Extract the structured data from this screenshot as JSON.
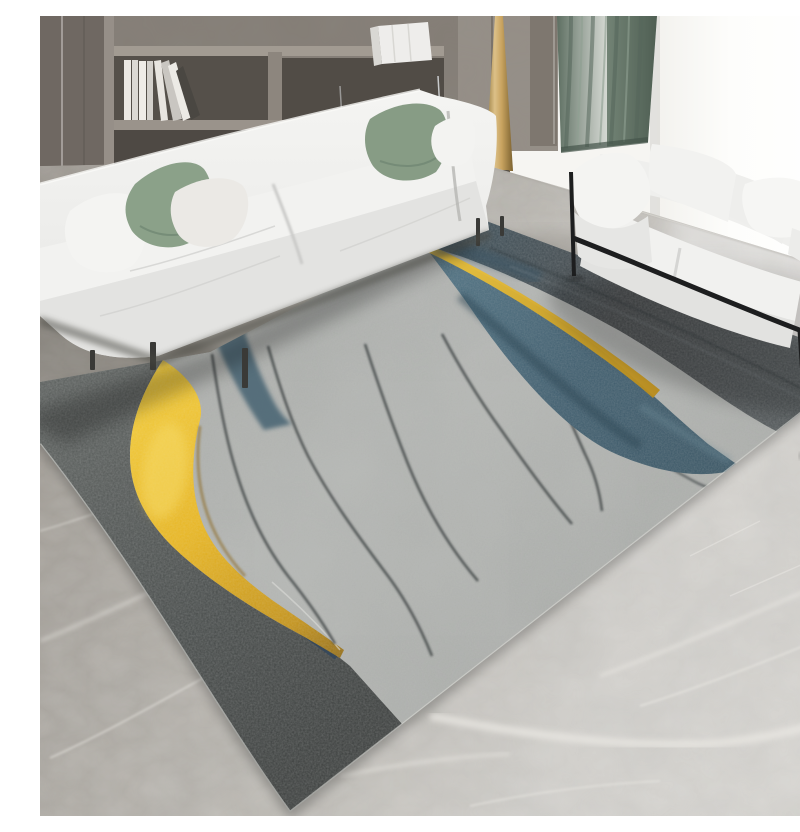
{
  "scene": {
    "description": "Photograph of a modern living room: white fabric sofa with sage-green and white pillows in front of a grey wood bookshelf, a white loveseat on a black metal frame by a bright window with a sage curtain and tall gold cone decor, all on grey marble tile flooring. A large abstract area rug lies in the centre with a mottled concrete-grey field, a dark charcoal wedge, a sweeping gold-foil crescent ribbon, steel-blue diagonal bands edged with thin gold piping and thin dark wavy lines.",
    "width_px": 800,
    "height_px": 800
  },
  "palette": {
    "wall_white": "#f6f5f2",
    "window_white": "#fdfdfb",
    "wood": "#8a837b",
    "wood_dark": "#6e6760",
    "wood_recess": "#534e48",
    "wood_board": "#a29b92",
    "book_white": "#eae8e3",
    "chrome": "#d5d8da",
    "panel": "#958e86",
    "panel_seam": "#7b746c",
    "curtain": "#6b7b6e",
    "curtain_dark": "#536356",
    "curtain_light": "#8fa092",
    "cone_gold": "#c8a35f",
    "cone_dark": "#8f7336",
    "floor_left": "#a29d96",
    "floor_mid": "#c6c3be",
    "floor_right": "#d7d5d1",
    "floor_vein": "#efede9",
    "floor_shadow": "#6e6a63",
    "rug_gray": "#b2b4b1",
    "rug_gray_light": "#c7c9c6",
    "rug_gray_dark": "#9a9d9a",
    "rug_charcoal": "#4b4e4d",
    "rug_charcoal_dark": "#363938",
    "band_charcoal": "#454b4e",
    "band_teal": "#3c5260",
    "blue": "#416071",
    "blue_light": "#5f7e8d",
    "blue_dark": "#314a59",
    "gold": "#e2af25",
    "gold_light": "#f6d663",
    "gold_dark": "#9c7414",
    "sofa_white": "#f0f0ee",
    "sofa_hi": "#f8f8f6",
    "sofa_shadow": "#d9d9d7",
    "sofa_deep": "#b9b9b7",
    "pillow_green": "#8ba189",
    "pillow_green_dark": "#6d8570",
    "leg_dark": "#35342f",
    "frame_black": "#1d1e1f"
  },
  "elements": {
    "bookshelf": {
      "white_books_left": 7,
      "white_boxes_top_right": 1,
      "chrome_rails": 2
    },
    "sofa_main": {
      "seats": 2,
      "pillows": [
        "white",
        "sage-green",
        "white",
        "sage-green",
        "white"
      ]
    },
    "loveseat": {
      "seats": 2,
      "pillows": [
        "white"
      ],
      "frame": "black metal"
    },
    "curtain_panels": 1,
    "decor": [
      "gold cone"
    ],
    "rug": {
      "style": "abstract",
      "features": [
        "charcoal wedge",
        "gold crescent ribbon",
        "small teal band",
        "wide steel-blue band with gold piping",
        "charcoal edge band",
        "thin dark wavy lines"
      ]
    }
  }
}
